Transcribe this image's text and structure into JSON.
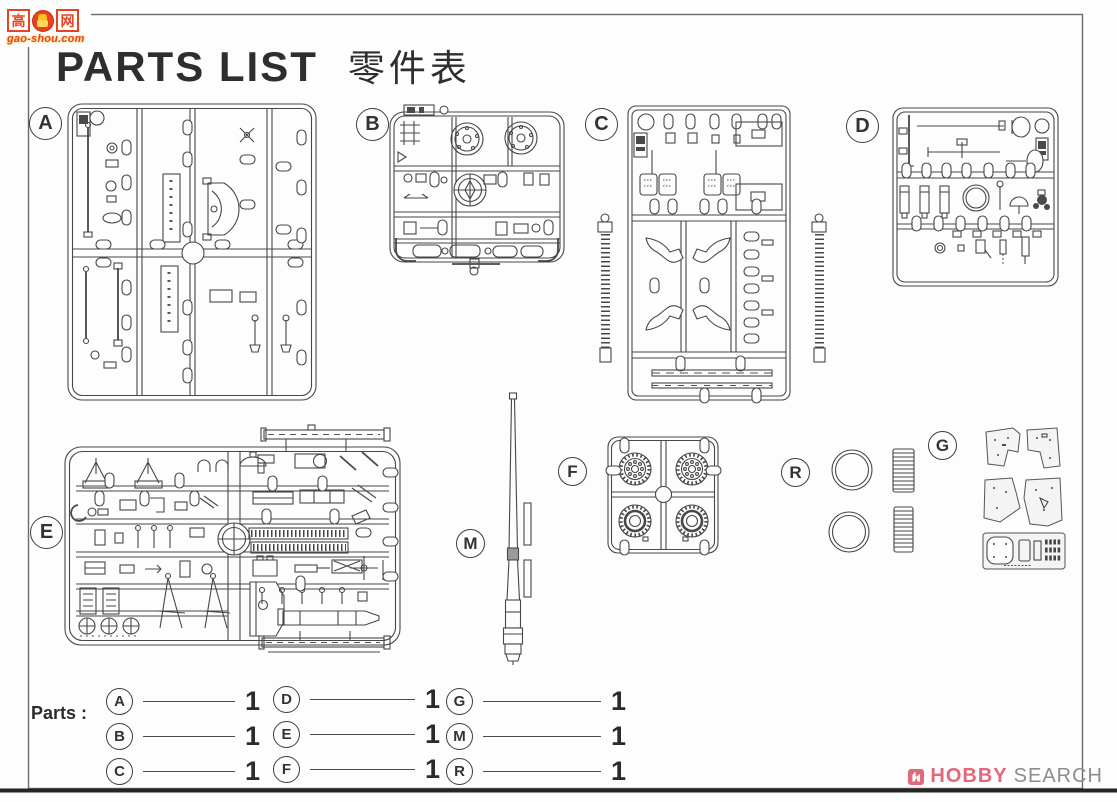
{
  "watermark": {
    "char_left": "高",
    "char_right": "网",
    "url_text": "gao-shou.com",
    "red": "#e8431f",
    "yellow": "#ffc21a"
  },
  "title": {
    "en": "PARTS LIST",
    "zh": "零件表"
  },
  "sprues": {
    "a": {
      "label": "A"
    },
    "b": {
      "label": "B"
    },
    "c": {
      "label": "C"
    },
    "d": {
      "label": "D"
    },
    "e": {
      "label": "E"
    },
    "f": {
      "label": "F"
    },
    "g": {
      "label": "G"
    },
    "m": {
      "label": "M"
    },
    "r": {
      "label": "R"
    }
  },
  "parts_table": {
    "heading": "Parts :",
    "entries": [
      {
        "label": "A",
        "qty": "1"
      },
      {
        "label": "B",
        "qty": "1"
      },
      {
        "label": "C",
        "qty": "1"
      },
      {
        "label": "D",
        "qty": "1"
      },
      {
        "label": "E",
        "qty": "1"
      },
      {
        "label": "F",
        "qty": "1"
      },
      {
        "label": "G",
        "qty": "1"
      },
      {
        "label": "M",
        "qty": "1"
      },
      {
        "label": "R",
        "qty": "1"
      }
    ]
  },
  "footer_logo": {
    "brand_primary": "HOBBY",
    "brand_secondary": "SEARCH",
    "accent": "#e0697b",
    "secondary_color": "#8d8d8d"
  }
}
